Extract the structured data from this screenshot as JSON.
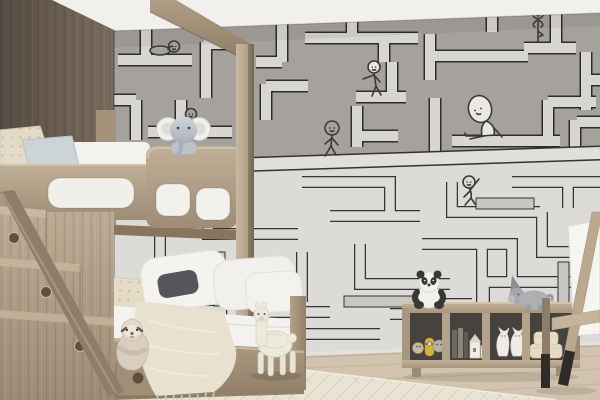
{
  "scene": {
    "title": "Children's bedroom with wooden bunk bed and hand-drawn maze wallpaper",
    "type": "photograph",
    "room": "kids bedroom"
  },
  "colors": {
    "ceiling": "#f2f0ed",
    "wallpaperUpper": "#a5a19c",
    "wallpaperLower": "#dcdbd8",
    "mazeLine": "#2e2d2b",
    "mazePathLight": "#d8d6d3",
    "woodWall": "#7b6c5f",
    "bedding": "#f4f2ee",
    "blanket": "#e9e1d0",
    "rug": "#eae4d5",
    "floor": "#d2c3ae",
    "shelfInterior": "#46423e"
  },
  "wallpaper": {
    "pattern": "hand-drawn maze with cartoon stick characters",
    "upper_zone": "gray background with light outlined corridors",
    "lower_zone": "light background with thin double-line maze",
    "figures": [
      {
        "name": "resting-figure",
        "pose": "lying on a maze path, upper left"
      },
      {
        "name": "climbing-figure",
        "pose": "standing beside a vertical path near the elephant"
      },
      {
        "name": "leaning-figure",
        "pose": "leaning against a maze wall, upper middle"
      },
      {
        "name": "yoga-figure",
        "pose": "tree pose with hair buns, upper right"
      },
      {
        "name": "big-head-figure",
        "pose": "sitting with legs outstretched on a ledge"
      },
      {
        "name": "walking-figure",
        "pose": "strolling along the zone-divider ledge"
      },
      {
        "name": "waving-figure",
        "pose": "crouching and waving, lower middle"
      },
      {
        "name": "doodle-figure",
        "pose": "small sketch near the bed foot"
      }
    ]
  },
  "furniture": [
    {
      "name": "bunk-bed",
      "material": "light ash wood",
      "features": "canopy beam, corner post, guard rail with cutouts"
    },
    {
      "name": "storage-stairs",
      "steps": 3,
      "features": "round finger holes"
    },
    {
      "name": "toy-shelf",
      "cubbies": 4
    },
    {
      "name": "easel",
      "features": "wooden frame, black leg tips, white canvas"
    }
  ],
  "toys": [
    {
      "name": "elephant-plush",
      "location": "sitting on top bunk guard rail"
    },
    {
      "name": "sloth-plush",
      "location": "sitting on bottom bunk edge"
    },
    {
      "name": "llama-plush",
      "location": "standing on floor beside bed"
    },
    {
      "name": "panda-plush",
      "location": "sitting on shelf top, left"
    },
    {
      "name": "unicorn-plush",
      "location": "lying on shelf top, right"
    },
    {
      "name": "cat-figurines",
      "count": 2,
      "location": "third shelf cubby"
    },
    {
      "name": "round-storage-boxes",
      "location": "fourth shelf cubby"
    },
    {
      "name": "books-and-toy-houses",
      "location": "second shelf cubby"
    },
    {
      "name": "mini-figures",
      "location": "first shelf cubby"
    }
  ],
  "textiles": [
    {
      "name": "white-bedding"
    },
    {
      "name": "patterned-pillow",
      "color": "#e3dac7"
    },
    {
      "name": "blue-pillow",
      "color": "#ccd4d8"
    },
    {
      "name": "dark-gray-pillow",
      "color": "#55555a"
    },
    {
      "name": "fringed-throw-blanket",
      "color": "#e9e1d0"
    },
    {
      "name": "cream-rug",
      "texture": "herringbone"
    }
  ]
}
